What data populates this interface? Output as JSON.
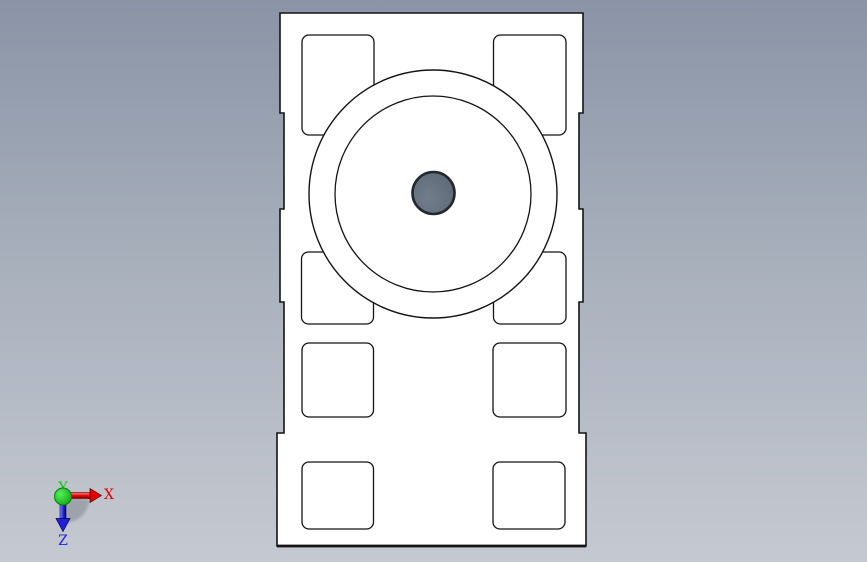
{
  "viewport": {
    "kind": "cad-3d-viewport",
    "view": "top-orthographic",
    "background": {
      "top": "#8a94a6",
      "middle": "#a8b0bc",
      "bottom": "#c5c9d1"
    }
  },
  "part": {
    "fill": "#ffffff",
    "outline_color": "#141414",
    "pocket_count": 8,
    "hole": {
      "stroke": "#23282e",
      "fill_light": "#727e8c",
      "fill_dark": "#5d6875"
    }
  },
  "triad": {
    "shadow_color": "#999ea6",
    "x": {
      "label": "X",
      "color": "#e00000",
      "shaft_light": "#ff8a7c",
      "shaft_mid": "#e00000",
      "shaft_dark": "#8f0000",
      "outline": "#5a0000"
    },
    "y": {
      "label": "Y",
      "color": "#00cc00",
      "sphere_light": "#55f05a",
      "sphere_dark": "#0ca112",
      "outline": "#0a7a0a"
    },
    "z": {
      "label": "Z",
      "color": "#2020d6",
      "shaft_light": "#8a94ff",
      "shaft_mid": "#2a2ad8",
      "shaft_dark": "#000090",
      "outline": "#000050"
    }
  }
}
